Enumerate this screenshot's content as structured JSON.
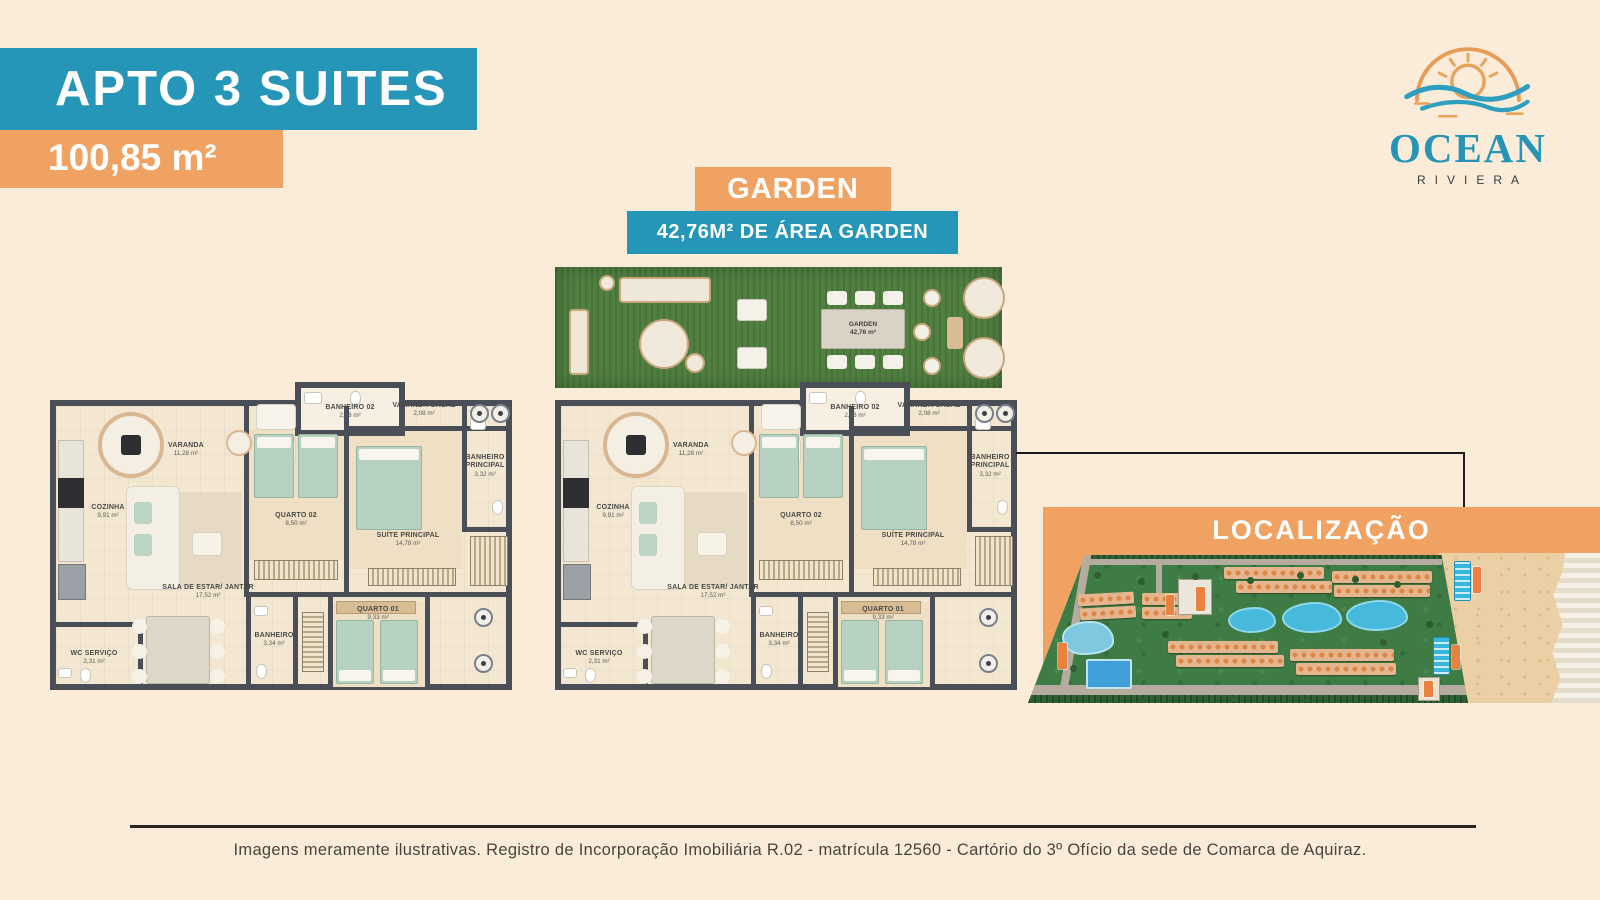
{
  "header": {
    "title": "APTO 3 SUITES",
    "area_value": "100,85 m²"
  },
  "logo": {
    "brand": "OCEAN",
    "sub": "RIVIERA"
  },
  "garden_banner": {
    "title": "GARDEN",
    "subtitle": "42,76M² DE ÁREA GARDEN"
  },
  "garden_area": {
    "label": "GARDEN",
    "area": "42,76 m²"
  },
  "rooms": [
    {
      "name": "VARANDA",
      "area": "11,28 m²"
    },
    {
      "name": "COZINHA",
      "area": "9,91 m²"
    },
    {
      "name": "BANHEIRO 02",
      "area": "2,88 m²"
    },
    {
      "name": "VARANDA CASAL",
      "area": "2,08 m²"
    },
    {
      "name": "QUARTO 02",
      "area": "8,50 m²"
    },
    {
      "name": "SUÍTE PRINCIPAL",
      "area": "14,78 m²"
    },
    {
      "name": "BANHEIRO PRINCIPAL",
      "area": "3,32 m²"
    },
    {
      "name": "SALA DE ESTAR/ JANTAR",
      "area": "17,52 m²"
    },
    {
      "name": "WC SERVIÇO",
      "area": "2,31 m²"
    },
    {
      "name": "BANHEIRO",
      "area": "3,34 m²"
    },
    {
      "name": "QUARTO 01",
      "area": "9,33 m²"
    }
  ],
  "location": {
    "title": "LOCALIZAÇÃO"
  },
  "footer": {
    "disclaimer": "Imagens meramente ilustrativas. Registro de Incorporação Imobiliária R.02 - matrícula 12560 - Cartório do 3º Ofício da sede de Comarca de Aquiraz."
  },
  "colors": {
    "teal": "#2596B7",
    "orange": "#F0A263",
    "background": "#FAECD9"
  }
}
